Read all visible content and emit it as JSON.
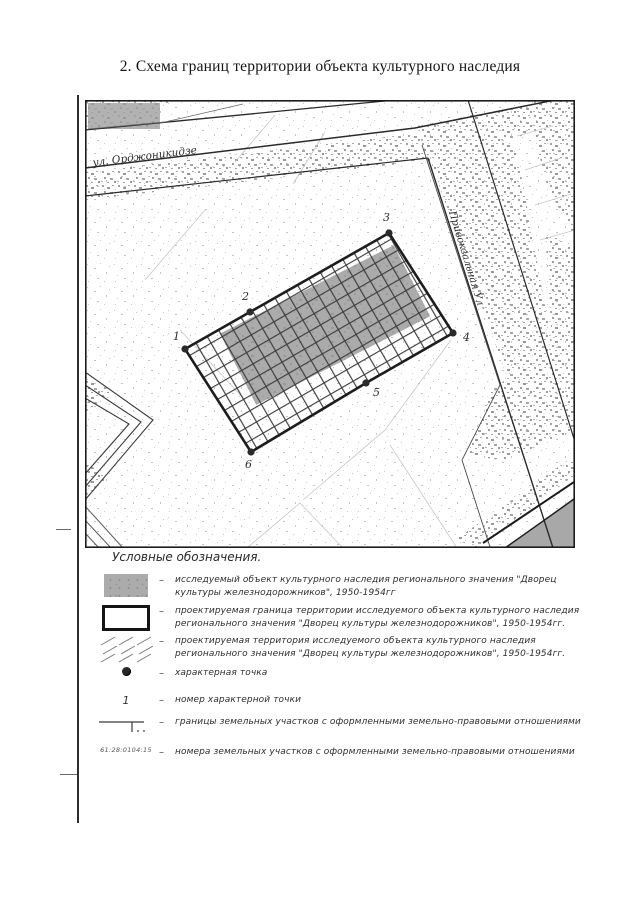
{
  "page": {
    "title": "2. Схема границ территории объекта культурного наследия"
  },
  "map": {
    "streets": [
      {
        "label": "ул. Орджоникидзе"
      },
      {
        "label": "Привокзальная Ул"
      }
    ],
    "points": [
      {
        "number": "1"
      },
      {
        "number": "2"
      },
      {
        "number": "3"
      },
      {
        "number": "4"
      },
      {
        "number": "5"
      },
      {
        "number": "6"
      }
    ]
  },
  "legend": {
    "heading": "Условные обозначения.",
    "separator": "–",
    "items": [
      {
        "symbol": "object-fill",
        "text": "исследуемый объект культурного наследия регионального значения \"Дворец культуры железнодорожников\", 1950-1954гг"
      },
      {
        "symbol": "boundary-rect",
        "text": "проектируемая граница территории исследуемого объекта культурного наследия регионального значения \"Дворец культуры железнодорожников\", 1950-1954гг."
      },
      {
        "symbol": "hatch",
        "text": "проектируемая территория исследуемого объекта культурного наследия регионального значения \"Дворец культуры железнодорожников\", 1950-1954гг."
      },
      {
        "symbol": "point-dot",
        "text": "характерная точка"
      },
      {
        "symbol": "point-number",
        "label": "1",
        "text": "номер характерной точки"
      },
      {
        "symbol": "parcel-line",
        "text": "границы земельных участков с оформленными земельно-правовыми отношениями"
      },
      {
        "symbol": "parcel-number",
        "label": "61:28:0104:15",
        "text": "номера земельных участков с оформленными земельно-правовыми отношениями"
      }
    ]
  },
  "colors": {
    "ink": "#1f1f1f",
    "speckle_light": "#c7c7c7",
    "speckle_dense": "#9d9d9d",
    "object_fill": "#ababab"
  }
}
